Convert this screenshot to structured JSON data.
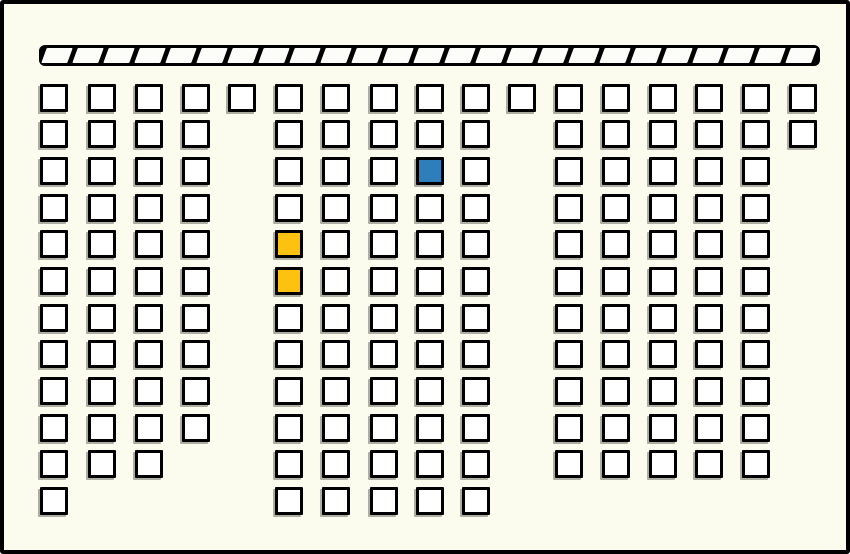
{
  "canvas": {
    "width": 850,
    "height": 554
  },
  "colors": {
    "background": "#FCFCEE",
    "frame_border": "#000000",
    "seat_fill": "#FFFFFF",
    "seat_border": "#000000",
    "seat_shadow": "rgba(110,108,98,0.55)",
    "selected_blue": "#2E7EBC",
    "highlight_orange": "#FDC110",
    "board_black": "#000000",
    "board_segment_white": "#FCFCF8"
  },
  "board": {
    "x": 35,
    "y": 41,
    "width": 781,
    "height": 21,
    "segments": 25
  },
  "seating": {
    "seat_size": 28,
    "col_x": [
      36,
      84,
      131,
      178,
      224,
      271,
      318,
      366,
      412,
      458,
      504,
      551,
      598,
      645,
      691,
      738,
      785
    ],
    "row_y": [
      80,
      116,
      153,
      190,
      226,
      263,
      300,
      336,
      373,
      410,
      446,
      483
    ],
    "rows": [
      {
        "cols": [
          0,
          1,
          2,
          3,
          4,
          5,
          6,
          7,
          8,
          9,
          10,
          11,
          12,
          13,
          14,
          15,
          16
        ]
      },
      {
        "cols": [
          0,
          1,
          2,
          3,
          5,
          6,
          7,
          8,
          9,
          11,
          12,
          13,
          14,
          15,
          16
        ]
      },
      {
        "cols": [
          0,
          1,
          2,
          3,
          5,
          6,
          7,
          8,
          9,
          11,
          12,
          13,
          14,
          15
        ]
      },
      {
        "cols": [
          0,
          1,
          2,
          3,
          5,
          6,
          7,
          8,
          9,
          11,
          12,
          13,
          14,
          15
        ]
      },
      {
        "cols": [
          0,
          1,
          2,
          3,
          5,
          6,
          7,
          8,
          9,
          11,
          12,
          13,
          14,
          15
        ]
      },
      {
        "cols": [
          0,
          1,
          2,
          3,
          5,
          6,
          7,
          8,
          9,
          11,
          12,
          13,
          14,
          15
        ]
      },
      {
        "cols": [
          0,
          1,
          2,
          3,
          5,
          6,
          7,
          8,
          9,
          11,
          12,
          13,
          14,
          15
        ]
      },
      {
        "cols": [
          0,
          1,
          2,
          3,
          5,
          6,
          7,
          8,
          9,
          11,
          12,
          13,
          14,
          15
        ]
      },
      {
        "cols": [
          0,
          1,
          2,
          3,
          5,
          6,
          7,
          8,
          9,
          11,
          12,
          13,
          14,
          15
        ]
      },
      {
        "cols": [
          0,
          1,
          2,
          3,
          5,
          6,
          7,
          8,
          9,
          11,
          12,
          13,
          14,
          15
        ]
      },
      {
        "cols": [
          0,
          1,
          2,
          5,
          6,
          7,
          8,
          9,
          11,
          12,
          13,
          14,
          15
        ]
      },
      {
        "cols": [
          0,
          5,
          6,
          7,
          8,
          9
        ]
      }
    ],
    "highlighted": [
      {
        "row": 2,
        "col": 8,
        "color_key": "selected_blue",
        "name": "selected-blue"
      },
      {
        "row": 4,
        "col": 5,
        "color_key": "highlight_orange",
        "name": "highlighted-orange-1"
      },
      {
        "row": 5,
        "col": 5,
        "color_key": "highlight_orange",
        "name": "highlighted-orange-2"
      }
    ]
  }
}
